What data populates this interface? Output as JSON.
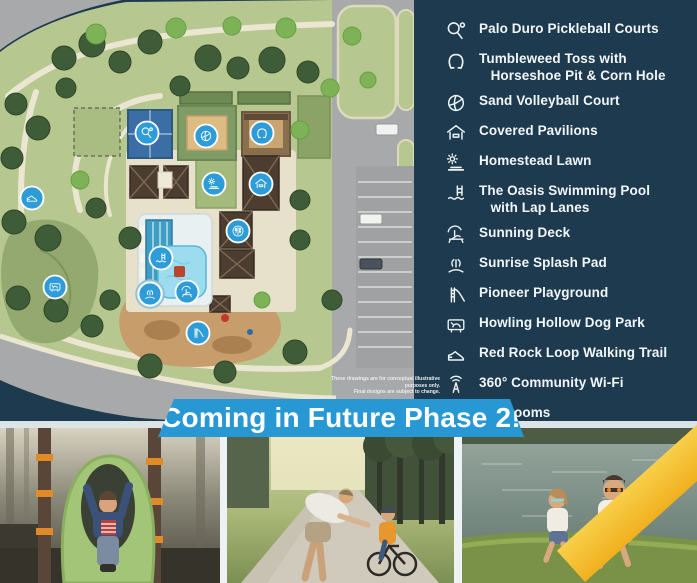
{
  "colors": {
    "panel_navy": "#1d3a4e",
    "banner_blue": "#2798d4",
    "marker_blue": "#2d9cd9",
    "accent_yellow": "#f2b92d"
  },
  "legend": {
    "items": [
      {
        "key": "pickleball",
        "icon": "pickleball-paddle-icon",
        "symbol": "i-pickleball",
        "label": "Palo Duro Pickleball Courts"
      },
      {
        "key": "horseshoe",
        "icon": "horseshoe-icon",
        "symbol": "i-horseshoe",
        "label": "Tumbleweed Toss with\n   Horseshoe Pit & Corn Hole"
      },
      {
        "key": "volleyball",
        "icon": "volleyball-icon",
        "symbol": "i-volleyball",
        "label": "Sand Volleyball Court"
      },
      {
        "key": "pavilions",
        "icon": "pavilion-icon",
        "symbol": "i-pavilion",
        "label": "Covered Pavilions"
      },
      {
        "key": "lawn",
        "icon": "lawn-sun-icon",
        "symbol": "i-lawn",
        "label": "Homestead Lawn"
      },
      {
        "key": "pool",
        "icon": "pool-ladder-icon",
        "symbol": "i-pool",
        "label": "The Oasis Swimming Pool\n   with Lap Lanes"
      },
      {
        "key": "sunning-deck",
        "icon": "sunning-deck-icon",
        "symbol": "i-sunning",
        "label": "Sunning Deck"
      },
      {
        "key": "splash-pad",
        "icon": "splash-pad-icon",
        "symbol": "i-splash",
        "label": "Sunrise Splash Pad"
      },
      {
        "key": "playground",
        "icon": "playground-slide-icon",
        "symbol": "i-playground",
        "label": "Pioneer Playground"
      },
      {
        "key": "dog-park",
        "icon": "dog-park-icon",
        "symbol": "i-dog",
        "label": "Howling Hollow Dog Park"
      },
      {
        "key": "walking-trail",
        "icon": "walking-shoe-icon",
        "symbol": "i-shoe",
        "label": "Red Rock Loop Walking Trail"
      },
      {
        "key": "wifi",
        "icon": "wifi-tower-icon",
        "symbol": "i-wifi",
        "label": "360° Community Wi-Fi"
      },
      {
        "key": "restrooms",
        "icon": "restrooms-icon",
        "symbol": "i-restrooms",
        "label": "Restrooms"
      }
    ]
  },
  "banner": {
    "text": "Coming in Future Phase 2!"
  },
  "disclaimer": {
    "line1": "These drawings are for conceptual illustrative purposes only.",
    "line2": "Final designs are subject to change."
  },
  "map": {
    "markers": [
      {
        "name": "pickleball-marker",
        "symbol": "i-pickleball",
        "x": 147,
        "y": 133
      },
      {
        "name": "volleyball-marker",
        "symbol": "i-volleyball",
        "x": 206,
        "y": 136
      },
      {
        "name": "horseshoe-marker",
        "symbol": "i-horseshoe",
        "x": 262,
        "y": 133
      },
      {
        "name": "lawn-marker",
        "symbol": "i-lawn",
        "x": 214,
        "y": 184
      },
      {
        "name": "pavilion-marker",
        "symbol": "i-pavilion",
        "x": 261,
        "y": 184
      },
      {
        "name": "restrooms-marker",
        "symbol": "i-restrooms",
        "x": 238,
        "y": 231
      },
      {
        "name": "pool-marker",
        "symbol": "i-pool",
        "x": 161,
        "y": 258
      },
      {
        "name": "splash-pad-marker",
        "symbol": "i-splash",
        "x": 150,
        "y": 294
      },
      {
        "name": "sunning-deck-marker",
        "symbol": "i-sunning",
        "x": 187,
        "y": 292
      },
      {
        "name": "playground-marker",
        "symbol": "i-playground",
        "x": 198,
        "y": 333
      },
      {
        "name": "dog-park-marker",
        "symbol": "i-dog",
        "x": 55,
        "y": 287
      },
      {
        "name": "walking-trail-marker",
        "symbol": "i-shoe",
        "x": 32,
        "y": 198
      }
    ]
  },
  "photos": [
    {
      "name": "photo-playground-slide",
      "description": "Child sliding down green playground tube slide"
    },
    {
      "name": "photo-family-biking",
      "description": "Father helping child ride a bike on tree-lined trail"
    },
    {
      "name": "photo-kids-fishing",
      "description": "Two kids in sunglasses fishing at the pond"
    }
  ]
}
